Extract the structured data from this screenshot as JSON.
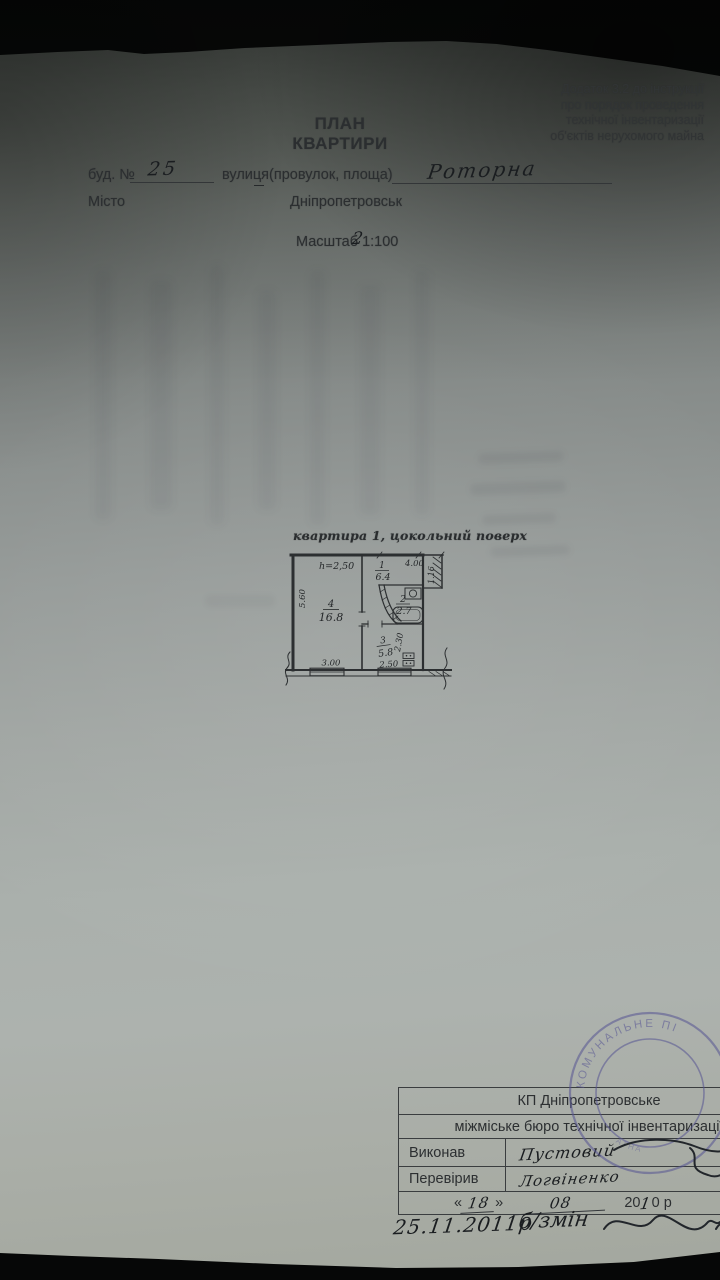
{
  "header": {
    "appendix_lines": [
      "Додаток 3.2 до інструкції",
      "про порядок проведення",
      "технічної інвентаризації",
      "об'єктів нерухомого майна"
    ],
    "title_line1": "ПЛАН",
    "title_line2": "КВАРТИРИ"
  },
  "address": {
    "building_label": "буд. №",
    "building_number": "25",
    "street_label": "вулиця(провулок, площа)",
    "street_name": "Роторна",
    "city_label": "Місто",
    "city_name": "Дніпропетровськ"
  },
  "scale": {
    "label": "Масштаб",
    "printed_value": "1:100",
    "handwritten_correction": "2"
  },
  "plan": {
    "caption": "квартира 1,  цокольний поверх",
    "ceiling_height": "h=2,50",
    "rooms": {
      "room1": {
        "number": "1",
        "area": "6.4"
      },
      "room2": {
        "number": "2",
        "area": "2.7"
      },
      "room3": {
        "number": "3",
        "area": "5.8"
      },
      "room4": {
        "number": "4",
        "area": "16.8"
      }
    },
    "dims": {
      "left_height": "5.60",
      "bottom_left": "3.00",
      "top_right": "4.00",
      "right_notch": "1.16",
      "right_mid": "2.30",
      "bottom_right": "2.50"
    }
  },
  "stamp": {
    "arc_top_fragment": "КОМУНАЛЬНЕ ПІ",
    "arc_bottom_fragment": "АТНА",
    "color": "#5a5896"
  },
  "footer_table": {
    "org_line1": "КП Дніпропетровське",
    "org_line2": "міжміське бюро технічної інвентаризації",
    "executed_label": "Виконав",
    "executed_by": "Пустовий",
    "checked_label": "Перевірив",
    "checked_by": "Логвіненко",
    "date": {
      "quote_open": "«",
      "day": "18",
      "quote_close": "»",
      "month": "08",
      "year_prefix": "20",
      "year_hand": "1",
      "year_rest": "0 р"
    }
  },
  "footnote": {
    "date": "25.11.2011р",
    "text": "б/змін"
  }
}
